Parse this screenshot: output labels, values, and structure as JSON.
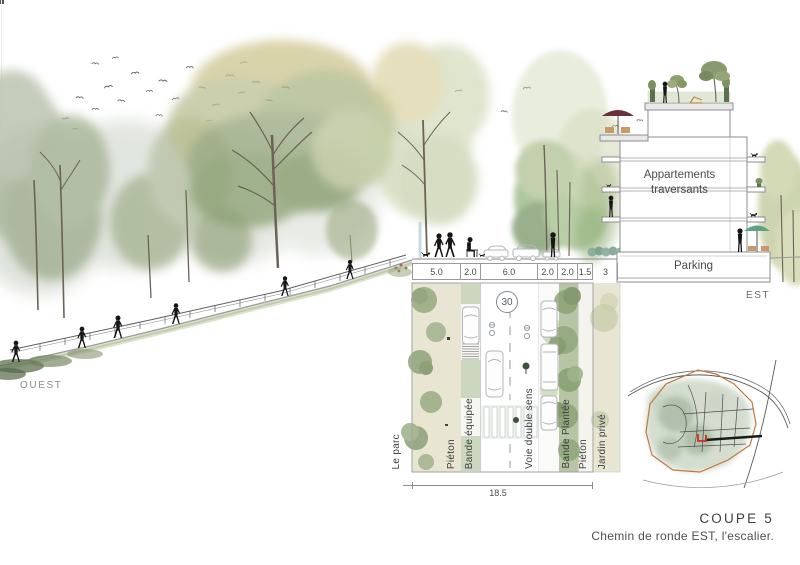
{
  "labels": {
    "west": "OUEST",
    "east": "EST"
  },
  "building": {
    "apartments_line1": "Appartements",
    "apartments_line2": "traversants",
    "parking": "Parking"
  },
  "plan": {
    "speed_sign": "30",
    "dimensions": [
      "5.0",
      "2.0",
      "6.0",
      "2.0",
      "2.0",
      "1.5"
    ],
    "setback_dimension": "3",
    "total_width": "18.5",
    "band_labels": [
      "Le parc",
      "Piéton",
      "Bande équipée",
      "Voie double sens",
      "Bande Plantée",
      "Piéton",
      "Jardin privé"
    ]
  },
  "caption": {
    "title": "COUPE 5",
    "subtitle": "Chemin de ronde EST, l'escalier."
  },
  "colors": {
    "beige_band": "#e9e5d3",
    "planted_band_green": "#b7c4a5",
    "map_boundary_orange": "#bd7a3e",
    "map_marker_red": "#cc2f1e",
    "umbrella_maroon": "#6e2f3c",
    "umbrella_green": "#5fa184",
    "silhouette_black": "#161616"
  }
}
